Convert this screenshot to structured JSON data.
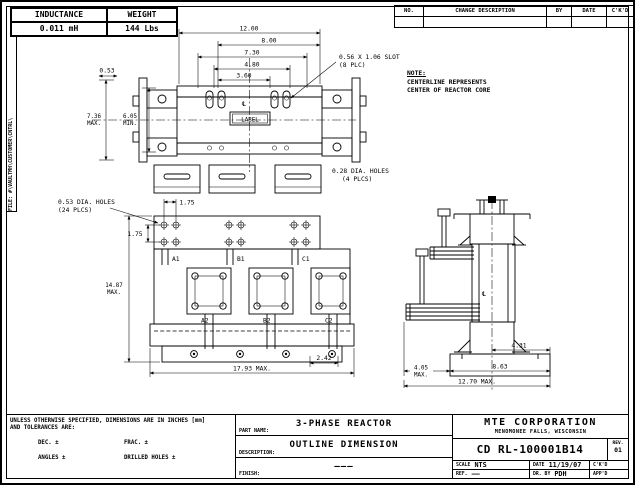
{
  "file_label": "FILE: #\\VAULTMH\\CUSTOMER\\CNTRL\\",
  "spec_table": {
    "inductance_label": "INDUCTANCE",
    "inductance_value": "0.011 mH",
    "weight_label": "WEIGHT",
    "weight_value": "144 Lbs"
  },
  "revision_table": {
    "no_label": "NO.",
    "change_label": "CHANGE DESCRIPTION",
    "by_label": "BY",
    "date_label": "DATE",
    "ckd_label": "C'K'D"
  },
  "note": {
    "title": "NOTE:",
    "line1": "CENTERLINE REPRESENTS",
    "line2": "CENTER OF REACTOR CORE"
  },
  "top_view": {
    "dim_width_overall": "12.00",
    "dim_8": "8.00",
    "dim_7_3": "7.30",
    "dim_4_8": "4.80",
    "dim_3_6": "3.60",
    "dim_0_53": "0.53",
    "dim_7_36": "7.36",
    "dim_7_36_suffix": "MAX.",
    "dim_6_05": "6.05",
    "dim_6_05_suffix": "MIN.",
    "slot_note_line1": "0.56 X 1.06 SLOT",
    "slot_note_line2": "(8 PLC)",
    "label_text": "LABEL",
    "holes_note_line1": "0.28 DIA. HOLES",
    "holes_note_line2": "(4 PLCS)",
    "centerline_symbol": "℄"
  },
  "front_view": {
    "holes_note_line1": "0.53 DIA. HOLES",
    "holes_note_line2": "(24 PLCS)",
    "dim_1_75_h": "1.75",
    "dim_1_75_v": "1.75",
    "dim_height": "14.87",
    "dim_height_suffix": "MAX.",
    "dim_width": "17.93 MAX.",
    "dim_2_42": "2.42",
    "terminals_top": [
      "A1",
      "B1",
      "C1"
    ],
    "terminals_bottom": [
      "A2",
      "B2",
      "C2"
    ]
  },
  "side_view": {
    "dim_4_31": "4.31",
    "dim_4_05": "4.05",
    "dim_4_05_suffix": "MAX.",
    "dim_8_63": "8.63",
    "dim_bottom": "12.70 MAX.",
    "centerline_symbol": "℄"
  },
  "tolerances": {
    "line1": "UNLESS OTHERWISE SPECIFIED, DIMENSIONS ARE IN INCHES [mm]",
    "line2": "AND TOLERANCES ARE:",
    "dec": "DEC. ±",
    "frac": "FRAC. ±",
    "angles": "ANGLES ±",
    "drilled": "DRILLED HOLES ±"
  },
  "title_block": {
    "part_name_label": "PART NAME:",
    "part_name": "3-PHASE REACTOR",
    "description_label": "DESCRIPTION:",
    "description": "OUTLINE DIMENSION",
    "finish_label": "FINISH:",
    "finish": "———",
    "company": "MTE CORPORATION",
    "company_location": "MENOMONEE FALLS, WISCONSIN",
    "drawing_number": "CD RL-100001B14",
    "rev_label": "REV.",
    "rev": "01",
    "scale_label": "SCALE",
    "scale": "NTS",
    "date_label": "DATE",
    "date": "11/19/07",
    "ckd_label": "C'K'D",
    "ref_label": "REF.",
    "ref": "——",
    "drawn_by_label": "DR. BY",
    "drawn_by": "PDH",
    "approved_label": "APP'D"
  }
}
